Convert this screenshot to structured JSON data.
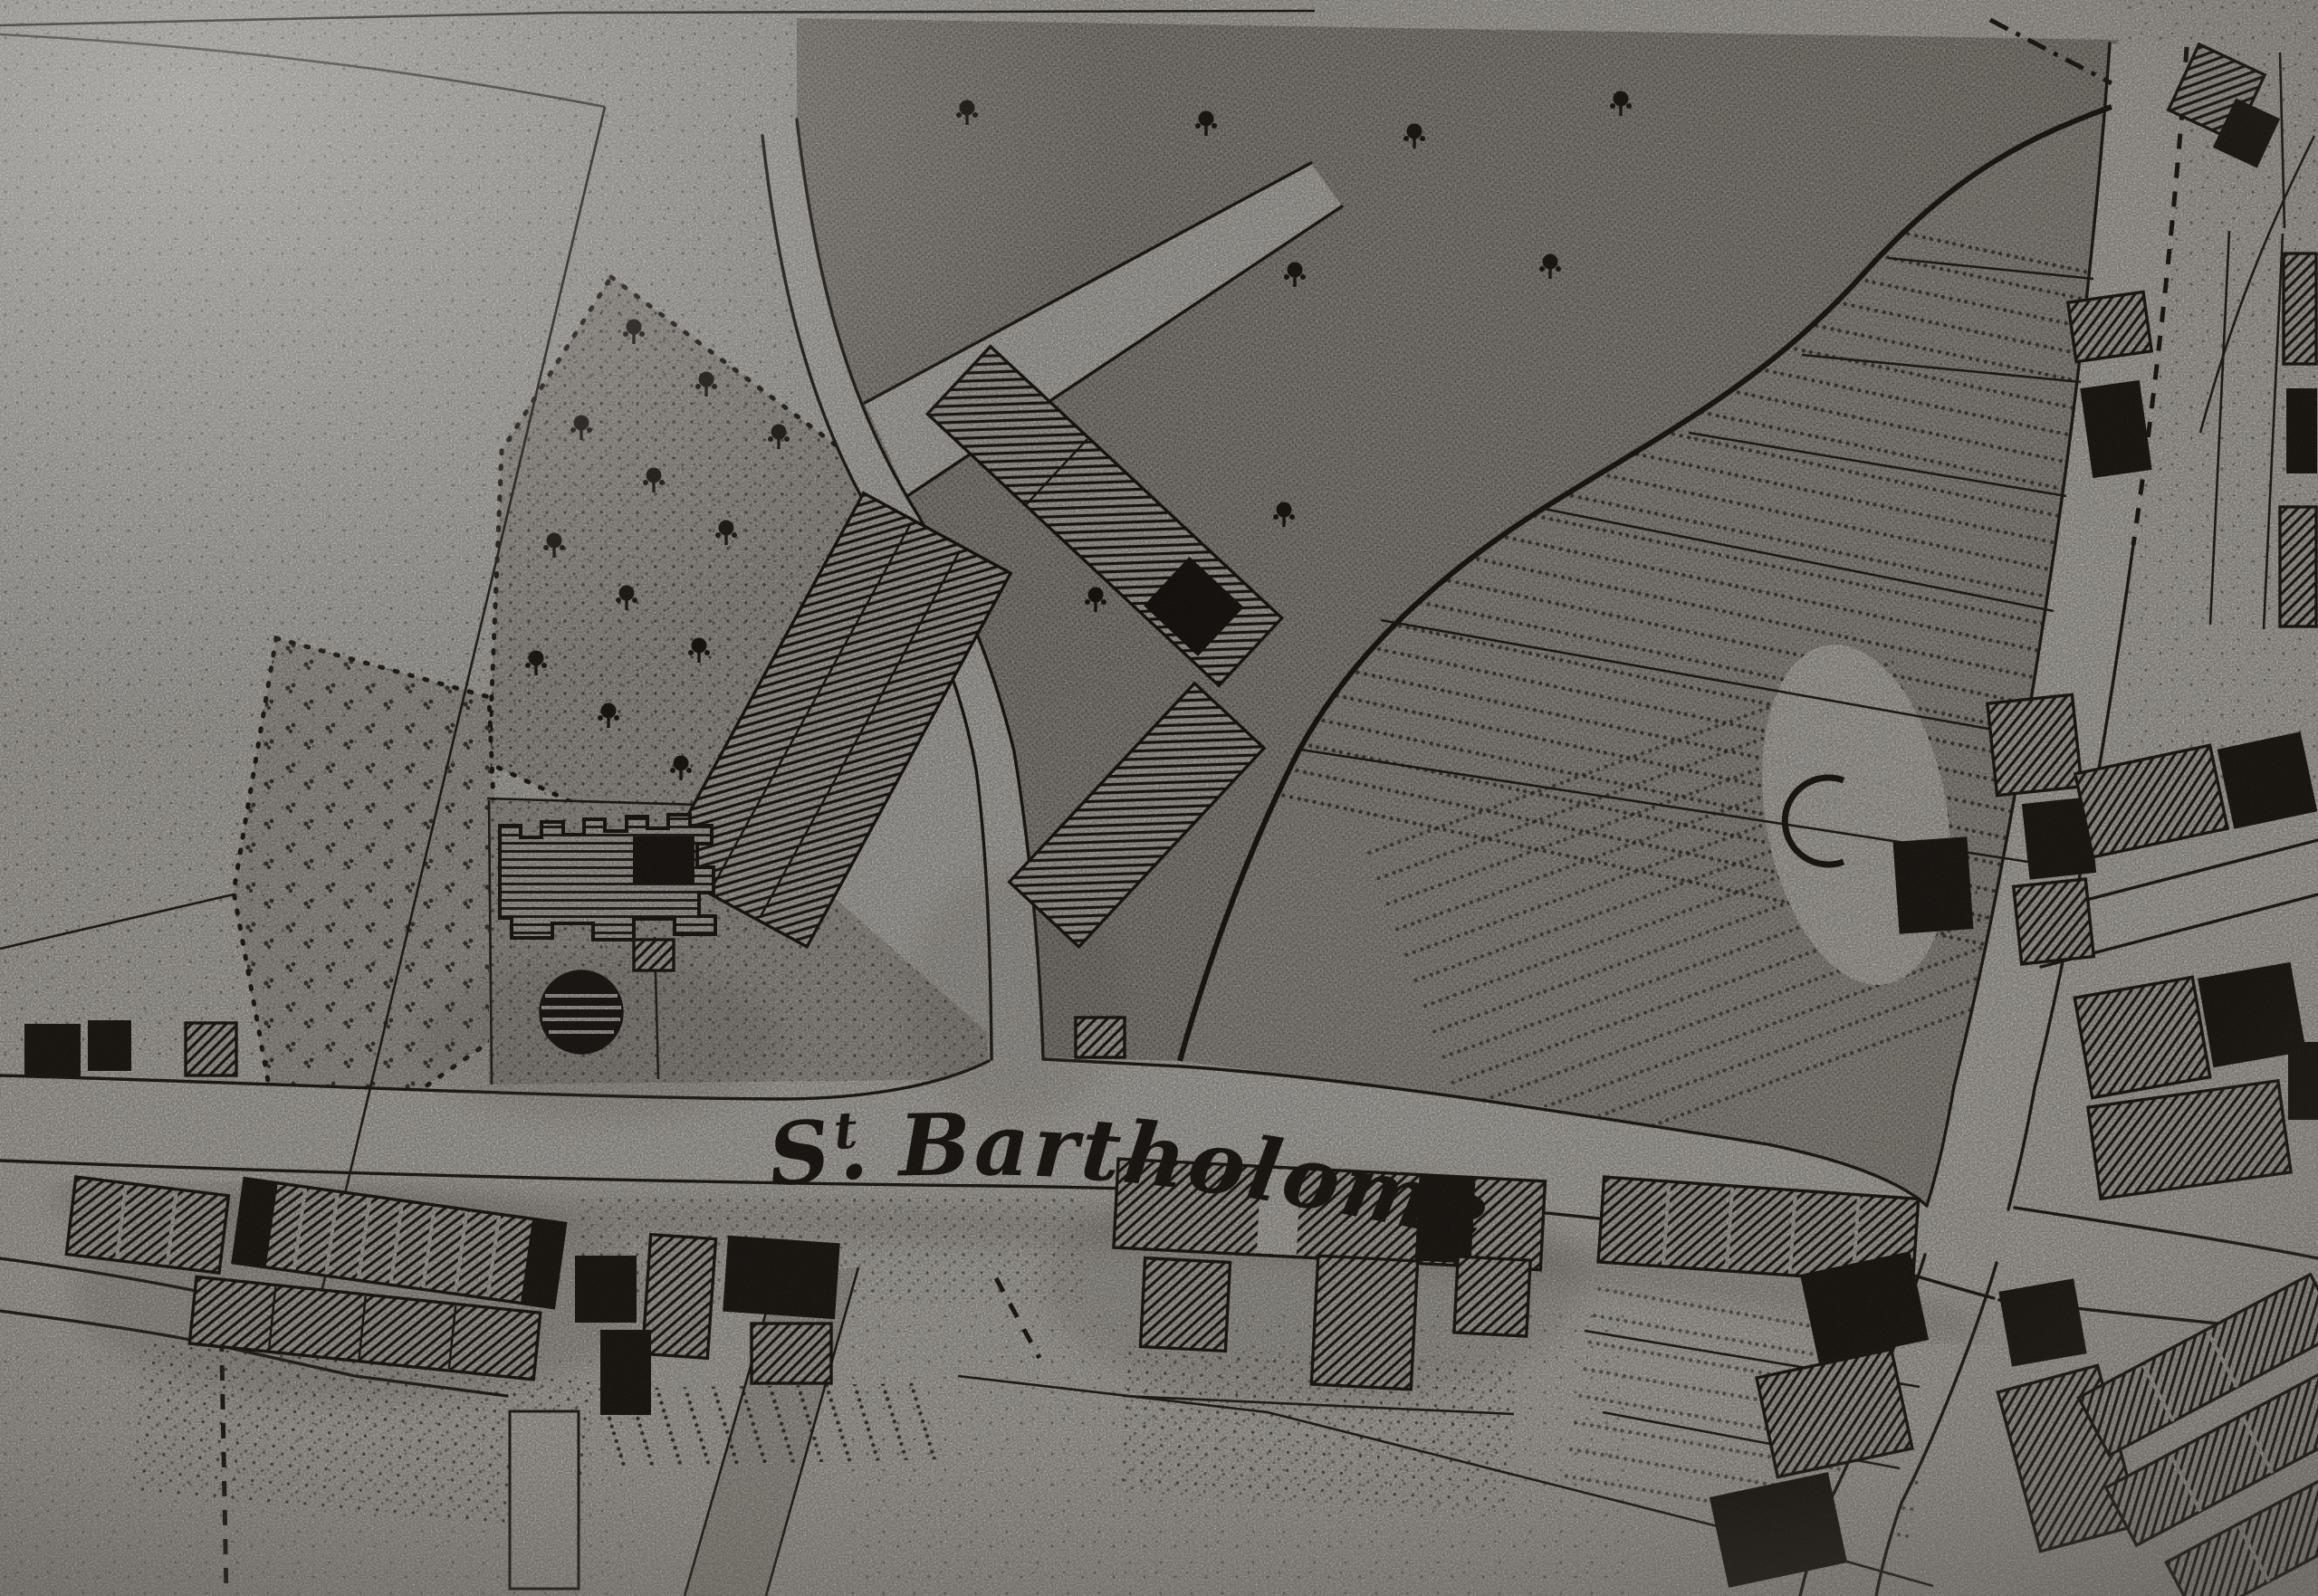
{
  "meta": {
    "alt": "Photographed page of a black-and-white 19th-century town map showing fields, an orchard, a castellated house with round pond, hatched building blocks, garden strips and a crossroads along a road labelled St Bartholomew"
  },
  "map": {
    "street_label": {
      "prefix": "S",
      "period": ".",
      "superscript": "t",
      "rest": "Bartholomew",
      "full": "St Bartholomew"
    },
    "palette": {
      "paper": "#e7e3dc",
      "paper_light": "#edeae3",
      "ink": "#231e18",
      "field_tone": "#b4ada3",
      "field_light": "#cbc5bb",
      "smudge": "#6e675e"
    }
  }
}
